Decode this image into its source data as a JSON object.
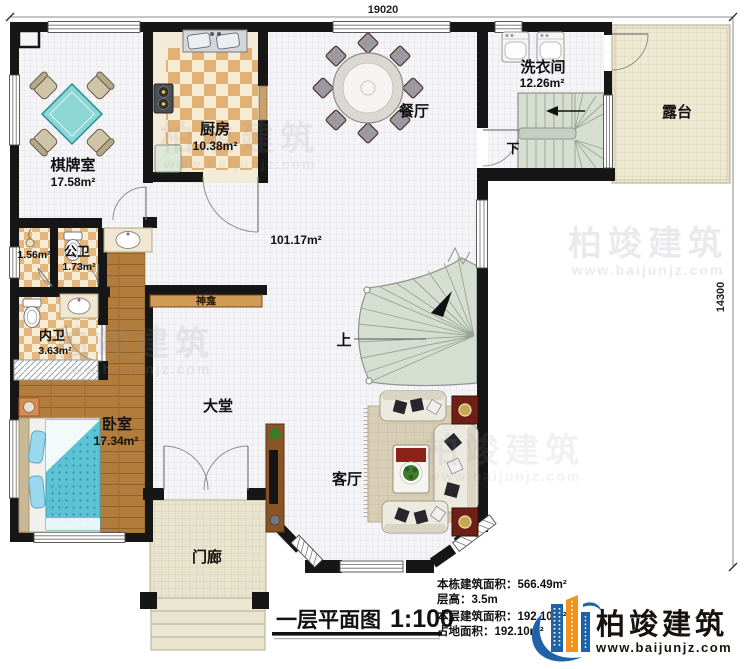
{
  "dimensions": {
    "top": "19020",
    "right": "14300"
  },
  "rooms": {
    "chess": {
      "name": "棋牌室",
      "area": "17.58m²"
    },
    "kitchen": {
      "name": "厨房",
      "area": "10.38m²"
    },
    "dining": {
      "name": "餐厅"
    },
    "laundry": {
      "name": "洗衣间",
      "area": "12.26m²"
    },
    "terrace": {
      "name": "露台"
    },
    "shower": {
      "area": "1.56m²"
    },
    "public_bath": {
      "name": "公卫",
      "area": "1.73m²"
    },
    "private_bath": {
      "name": "内卫",
      "area": "3.63m²"
    },
    "shrine": {
      "name": "神龛"
    },
    "bedroom": {
      "name": "卧室",
      "area": "17.34m²"
    },
    "lobby": {
      "name": "大堂"
    },
    "living": {
      "name": "客厅"
    },
    "porch": {
      "name": "门廊"
    },
    "hall": {
      "area": "101.17m²"
    },
    "stairs_up": {
      "label": "上"
    },
    "stairs_down": {
      "label": "下"
    }
  },
  "title": {
    "text": "一层平面图",
    "scale": "1:100"
  },
  "info": {
    "rows": [
      {
        "label": "本栋建筑面积：",
        "value": "566.49m²"
      },
      {
        "label": "层高：",
        "value": "3.5m"
      },
      {
        "label": "本层建筑面积：",
        "value": "192.10m²"
      },
      {
        "label": "占地面积：",
        "value": "192.10m²"
      }
    ]
  },
  "logo": {
    "name": "柏竣建筑",
    "url": "www.baijunjz.com"
  },
  "watermark": {
    "name": "柏竣建筑",
    "url": "www.baijunjz.com"
  },
  "colors": {
    "wall": "#161616",
    "logo_blue": "#1e62a8",
    "logo_orange": "#f0941e",
    "stair": "#d6ded2",
    "wood": "#b27c3c"
  }
}
